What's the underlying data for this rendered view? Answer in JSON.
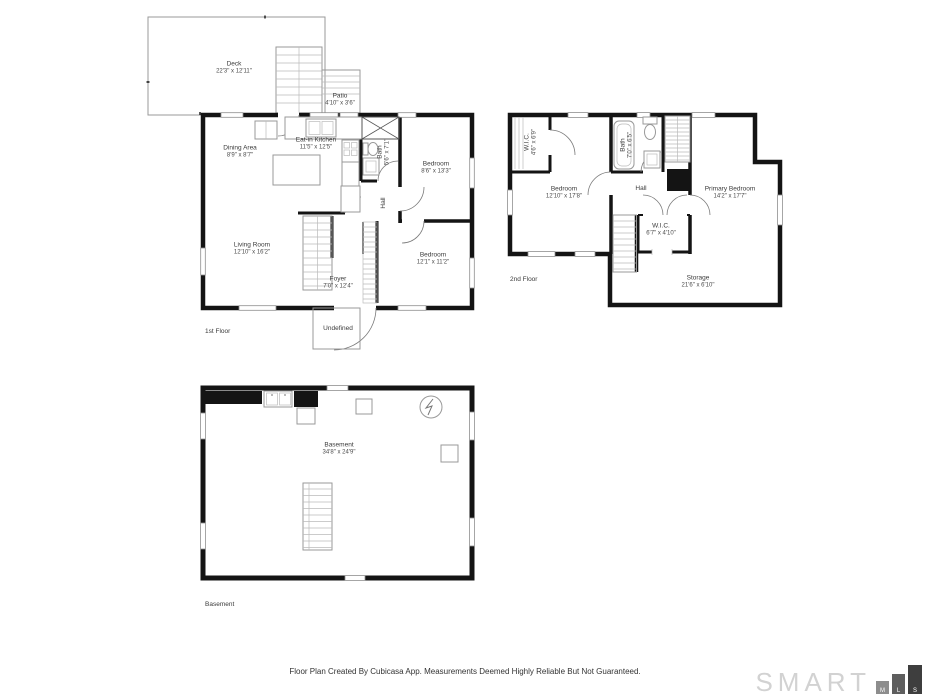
{
  "page": {
    "background": "#ffffff",
    "wall_color": "#141414"
  },
  "floors": [
    {
      "label": "1st Floor",
      "rooms": [
        {
          "name": "Deck",
          "dims": "22'3\" x 12'11\""
        },
        {
          "name": "Patio",
          "dims": "4'10\" x 3'6\""
        },
        {
          "name": "Eat-in Kitchen",
          "dims": "11'5\" x 12'5\""
        },
        {
          "name": "Dining Area",
          "dims": "8'9\" x 8'7\""
        },
        {
          "name": "Bedroom",
          "dims": "8'6\" x 13'3\""
        },
        {
          "name": "Bath",
          "dims": "5'6\" x 7'1\""
        },
        {
          "name": "Hall",
          "dims": ""
        },
        {
          "name": "Living Room",
          "dims": "12'10\" x 16'2\""
        },
        {
          "name": "Bedroom",
          "dims": "12'1\" x 11'2\""
        },
        {
          "name": "Foyer",
          "dims": "7'0\" x 12'4\""
        },
        {
          "name": "Undefined",
          "dims": ""
        }
      ]
    },
    {
      "label": "2nd Floor",
      "rooms": [
        {
          "name": "W.I.C.",
          "dims": "4'6\" x 6'9\""
        },
        {
          "name": "Bedroom",
          "dims": "12'10\" x 17'8\""
        },
        {
          "name": "Bath",
          "dims": "7'0\" x 6'5\""
        },
        {
          "name": "Hall",
          "dims": ""
        },
        {
          "name": "Primary Bedroom",
          "dims": "14'2\" x 17'7\""
        },
        {
          "name": "W.I.C.",
          "dims": "6'7\" x 4'10\""
        },
        {
          "name": "Storage",
          "dims": "21'6\" x 6'10\""
        }
      ]
    },
    {
      "label": "Basement",
      "rooms": [
        {
          "name": "Basement",
          "dims": "34'8\" x 24'9\""
        }
      ]
    }
  ],
  "footer": {
    "disclaimer": "Floor Plan Created By Cubicasa App. Measurements Deemed Highly Reliable But Not Guaranteed."
  },
  "logo": {
    "brand": "SMART",
    "blocks": [
      "M",
      "L",
      "S"
    ]
  }
}
